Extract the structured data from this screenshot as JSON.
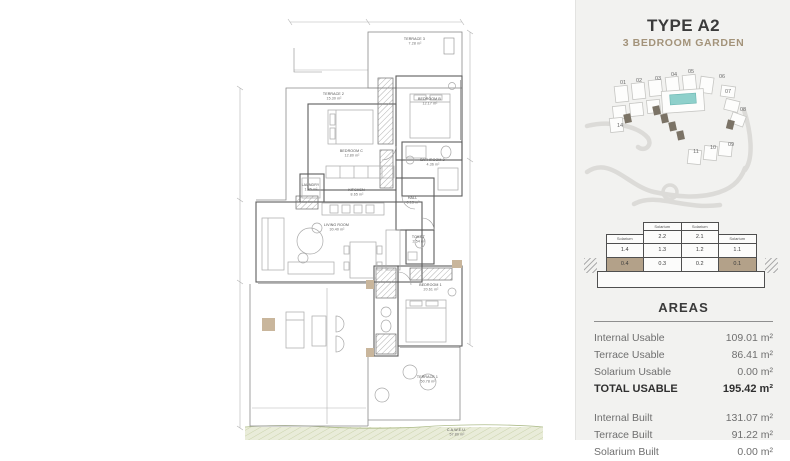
{
  "disclaimer": {
    "line1": "ion purposes only. The areas and measurements shown are approximate and may be modified for technical reasons and/or",
    "line2": "ture shown is for illustrative purposes. *C.A.W.E.U. stands for Communal Area With Exclusive Use."
  },
  "header": {
    "title": "TYPE A2",
    "subtitle": "3 BEDROOM GARDEN",
    "subtitle_color": "#a3937a"
  },
  "floor_plan": {
    "rooms": [
      {
        "name": "TERRACE 3",
        "area": "7.28 m²"
      },
      {
        "name": "BEDROOM B",
        "area": "12.17 m²"
      },
      {
        "name": "TERRACE 2",
        "area": "15.30 m²"
      },
      {
        "name": "BEDROOM C",
        "area": "12.80 m²"
      },
      {
        "name": "BATHROOM 2",
        "area": "4.36 m²"
      },
      {
        "name": "LAUNDRY",
        "area": "1.85 m²"
      },
      {
        "name": "KITCHEN",
        "area": "8.65 m²"
      },
      {
        "name": "HALL",
        "area": "6.13 m²"
      },
      {
        "name": "LIVING ROOM",
        "area": "30.40 m²"
      },
      {
        "name": "TOILET",
        "area": "2.54 m²"
      },
      {
        "name": "BEDROOM 1",
        "area": "20.61 m²"
      },
      {
        "name": "TERRACE 1",
        "area": "50.78 m²"
      },
      {
        "name": "C.A.W.E.U.",
        "area": "57.80 m²"
      }
    ]
  },
  "site_plan": {
    "block_numbers": [
      "01",
      "02",
      "03",
      "04",
      "05",
      "06",
      "07",
      "08",
      "09",
      "10",
      "11",
      "14"
    ],
    "pool_color": "#8ed0cb",
    "highlight_building_color": "#7b7366"
  },
  "building_section": {
    "solarium_label": "Solarium",
    "floor2": [
      "2.2",
      "2.1"
    ],
    "floor1": [
      "1.4",
      "1.3",
      "1.2",
      "1.1"
    ],
    "floor0": [
      "0.4",
      "0.3",
      "0.2",
      "0.1"
    ],
    "highlighted_units": [
      "0.4",
      "0.1"
    ],
    "highlight_color": "#b3a189"
  },
  "areas": {
    "title": "AREAS",
    "usable": [
      {
        "label": "Internal Usable",
        "value": "109.01 m²"
      },
      {
        "label": "Terrace Usable",
        "value": "86.41 m²"
      },
      {
        "label": "Solarium Usable",
        "value": "0.00 m²"
      }
    ],
    "total": {
      "label": "TOTAL USABLE",
      "value": "195.42 m²"
    },
    "built": [
      {
        "label": "Internal Built",
        "value": "131.07 m²"
      },
      {
        "label": "Terrace Built",
        "value": "91.22 m²"
      },
      {
        "label": "Solarium Built",
        "value": "0.00 m²"
      }
    ]
  }
}
